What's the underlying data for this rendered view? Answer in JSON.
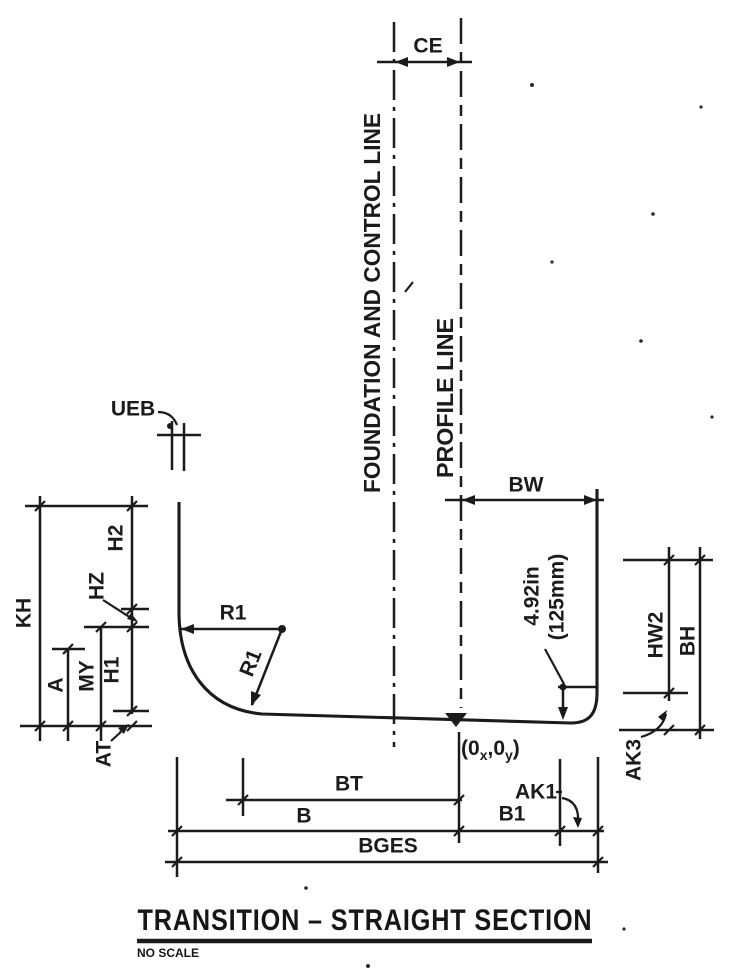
{
  "drawing": {
    "title": "TRANSITION – STRAIGHT SECTION",
    "scale_note": "NO SCALE",
    "reference_lines": {
      "foundation": "FOUNDATION AND CONTROL LINE",
      "profile": "PROFILE LINE"
    },
    "dimensions": {
      "ce": "CE",
      "ueb": "UEB",
      "kh": "KH",
      "h2": "H2",
      "hz": "HZ",
      "h1": "H1",
      "my": "MY",
      "a": "A",
      "at": "AT",
      "r1_horizontal": "R1",
      "r1_radial": "R1",
      "bw": "BW",
      "ledge_in": "4.92in",
      "ledge_mm": "(125mm)",
      "hw2": "HW2",
      "bh": "BH",
      "ak3": "AK3",
      "bt": "BT",
      "b": "B",
      "b1": "B1",
      "ak1": "AK1",
      "bges": "BGES"
    },
    "origin_label": {
      "pre": "(0",
      "sub_x": "x",
      "mid": ",0",
      "sub_y": "y",
      "post": ")"
    }
  }
}
